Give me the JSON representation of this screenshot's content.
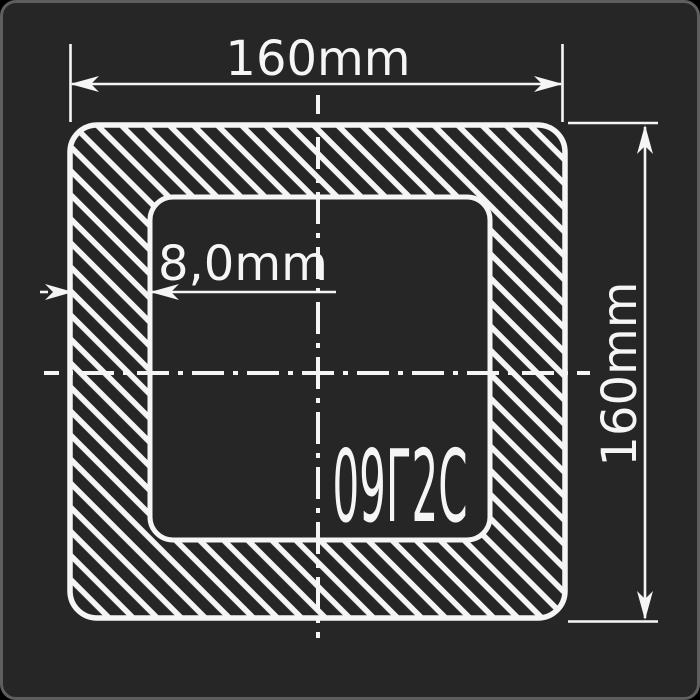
{
  "drawing": {
    "dimensions": {
      "outer_width": {
        "label": "160mm"
      },
      "outer_height": {
        "label": "160mm"
      },
      "wall_thickness": {
        "label": "8,0mm"
      }
    },
    "material": {
      "grade": "09Г2С"
    }
  },
  "colors": {
    "canvas_background": "#000000",
    "card_background": "#262626",
    "card_border": "#5e5e5e",
    "line_color": "#f5f5f5"
  }
}
